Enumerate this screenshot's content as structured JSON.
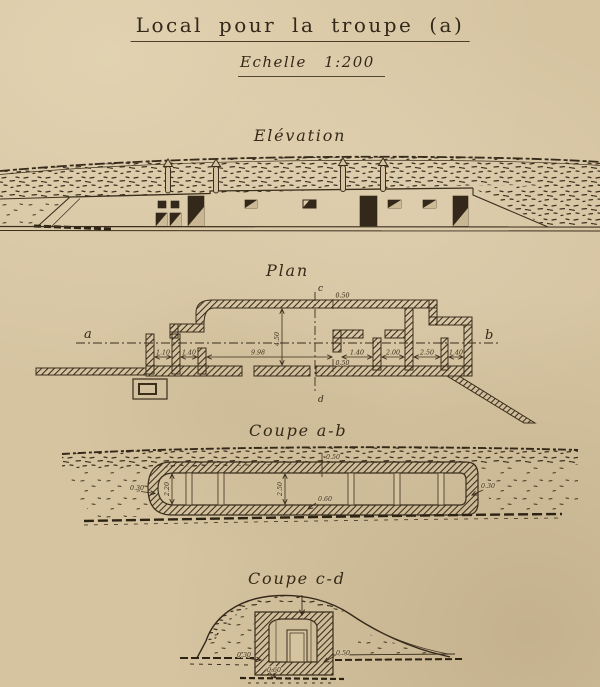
{
  "colors": {
    "paper": "#d6c4a1",
    "ink": "#382c1a"
  },
  "header": {
    "title": "Local pour la troupe (a)",
    "scale": "Echelle 1:200"
  },
  "elevation": {
    "label": "Elévation"
  },
  "plan": {
    "label": "Plan",
    "marker_a": "a",
    "marker_b": "b",
    "marker_c": "c",
    "marker_d": "d",
    "dim_wall_top": "0.50",
    "dim_wall_bottom": "0.50",
    "dim_depth": "4.50",
    "dim_length": "9.98",
    "dim_corridor": "1.10",
    "dim_entry": "1.40",
    "dim_room1": "1.40",
    "dim_room2": "2.00",
    "dim_room3": "2.50",
    "dim_room4": "1.40"
  },
  "coupe_ab": {
    "label": "Coupe a-b",
    "dim_roof": "0.50",
    "dim_left_wall": "0.30",
    "dim_height_left": "2.20",
    "dim_height_main": "2.50",
    "dim_floor": "0.60",
    "dim_right_wall": "0.30"
  },
  "coupe_cd": {
    "label": "Coupe c-d",
    "dim_left_wall": "0.30",
    "dim_floor": "0.60",
    "dim_right_wall": "0.50"
  }
}
